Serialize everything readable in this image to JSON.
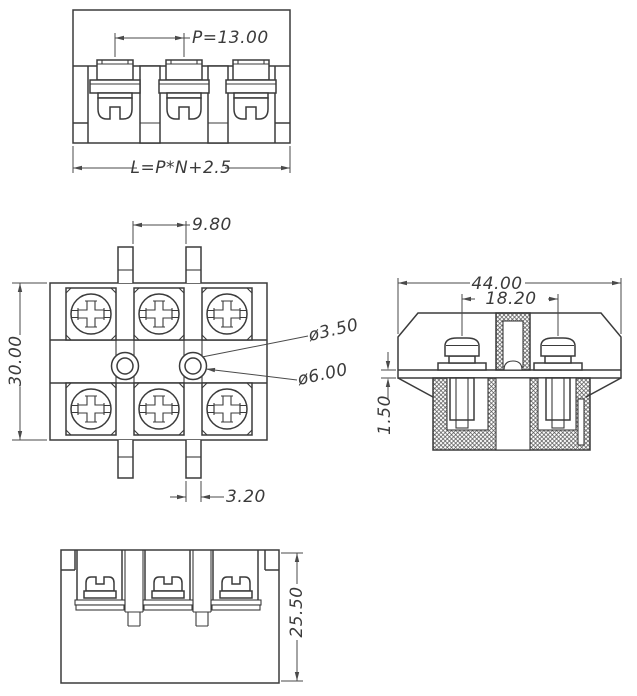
{
  "drawing": {
    "background": "#ffffff",
    "line_color": "#3b3b3b",
    "dim_color": "#4a4a4a",
    "views": {
      "front": {
        "dims": {
          "pitch": "P=13.00",
          "total_length": "L=P*N+2.5"
        }
      },
      "top": {
        "dims": {
          "tab_gap": "9.80",
          "depth": "30.00",
          "hole_small": "ø3.50",
          "hole_large": "ø6.00",
          "tab_width": "3.20"
        }
      },
      "section": {
        "dims": {
          "overall_width": "44.00",
          "screw_spacing": "18.20",
          "flange_thickness": "1.50"
        }
      },
      "bottom": {
        "dims": {
          "overall_height": "25.50"
        }
      }
    }
  }
}
